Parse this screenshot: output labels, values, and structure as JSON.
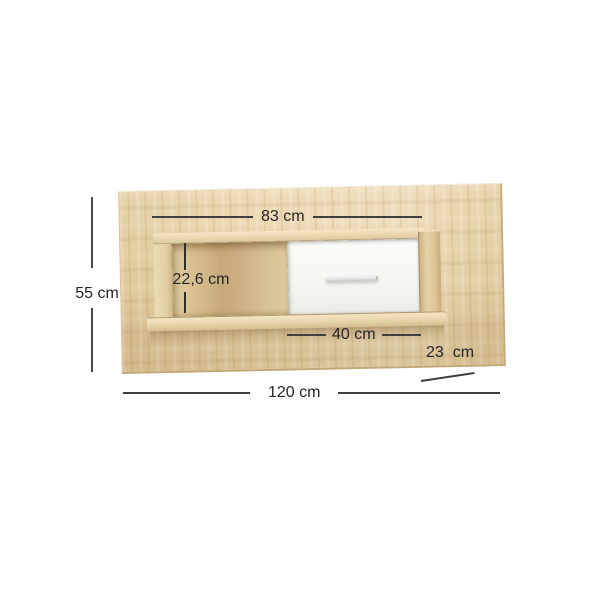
{
  "diagram": {
    "kind": "furniture-dimension-diagram",
    "product": "oak wall-mounted shelf panel with open compartment and white drawer flap",
    "background_color": "#ffffff"
  },
  "dims": {
    "shelf_width": {
      "label": "83 cm",
      "value_cm": 83,
      "orientation": "horizontal",
      "refers_to": "shelf unit width"
    },
    "panel_height": {
      "label": "55 cm",
      "value_cm": 55,
      "orientation": "vertical",
      "refers_to": "back panel height"
    },
    "compartment_height": {
      "label": "22,6 cm",
      "value_cm": 22.6,
      "orientation": "vertical",
      "refers_to": "open compartment inner height"
    },
    "drawer_width": {
      "label": "40 cm",
      "value_cm": 40,
      "orientation": "horizontal",
      "refers_to": "drawer front width"
    },
    "depth": {
      "label": "23  cm",
      "value_cm": 23,
      "orientation": "diagonal",
      "refers_to": "shelf depth"
    },
    "total_width": {
      "label": "120 cm",
      "value_cm": 120,
      "orientation": "horizontal",
      "refers_to": "back panel total width"
    }
  },
  "colors": {
    "oak_base": "#e6d2a7",
    "oak_light": "#f3e6c6",
    "oak_dark": "#c7aa7a",
    "drawer_white": "#f7f7f4",
    "handle_gray": "#e3e3e3",
    "dimension_line": "#3f3f3f",
    "dimension_text": "#262626"
  }
}
